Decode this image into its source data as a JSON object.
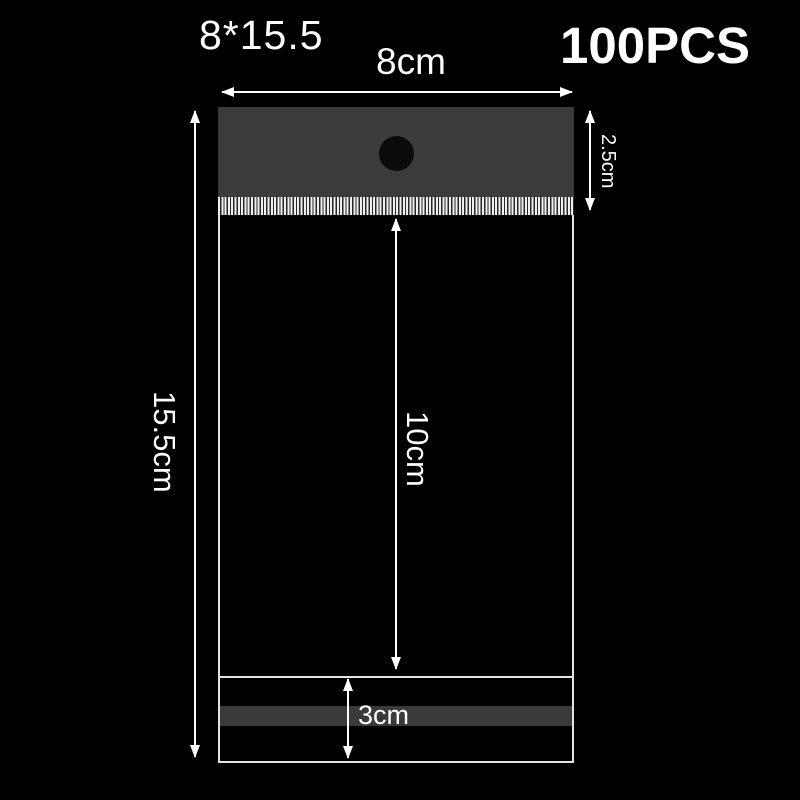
{
  "product": {
    "size_label": "8*15.5",
    "quantity_label": "100PCS"
  },
  "annotations": {
    "width_label": "8cm",
    "total_height_label": "15.5cm",
    "header_height_label": "2.5cm",
    "body_height_label": "10cm",
    "flap_height_label": "3cm"
  },
  "icons": {
    "hang_hole": "black-circle",
    "serration": "vertical-stripe-tear-edge",
    "arrows": "double-headed-dimension-arrows"
  },
  "colors": {
    "background": "#000000",
    "bag_header": "#3b3b3b",
    "adhesive_strip": "#3a3a3a",
    "bag_outline": "#e3e3e3",
    "serration_light": "#f0f0f0",
    "serration_dark": "#262626",
    "hole": "#0b0b0b",
    "text": "#fdfdfd"
  }
}
